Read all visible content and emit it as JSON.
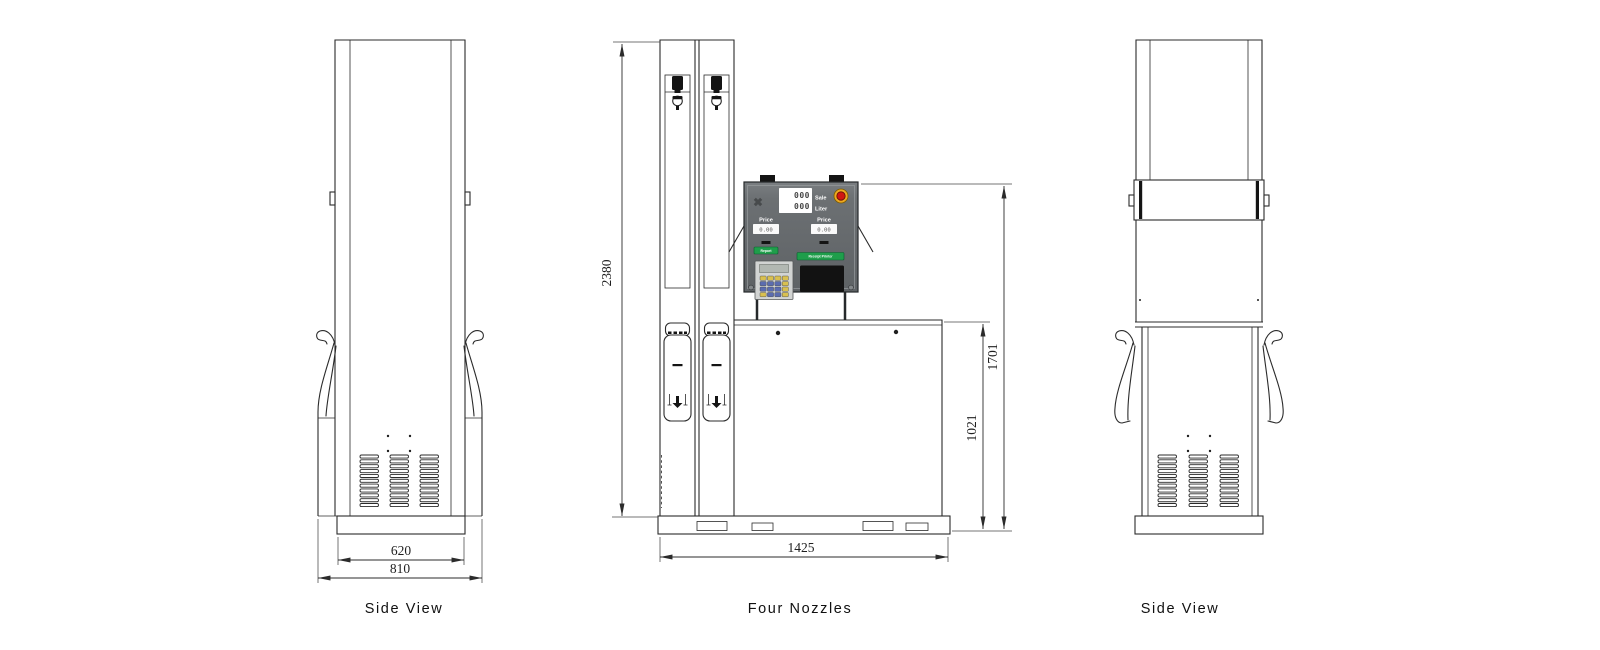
{
  "views": {
    "left": {
      "label": "Side View",
      "dim_top_width": "620",
      "dim_base_width": "810"
    },
    "front": {
      "label": "Four Nozzles",
      "dim_total_height": "2380",
      "dim_base_width": "1425",
      "dim_display_height": "1701",
      "dim_cabinet_height": "1021"
    },
    "right": {
      "label": "Side View"
    }
  },
  "panel": {
    "sale_label": "Sale",
    "liter_label": "Liter",
    "sale_value": "000",
    "liter_value": "000",
    "price_left_label": "Price",
    "price_right_label": "Price",
    "price_left_value": "0.00",
    "price_right_value": "0.00",
    "report_button_label": "Report",
    "receipt_button_label": "Receipt Printer"
  },
  "colors": {
    "line": "#2b2b2b",
    "panel_body": "#696d70",
    "button_green": "#1f9e4b",
    "estop_red": "#d01611",
    "estop_ring": "#eda81f",
    "keypad_blue": "#5b6cb0",
    "keypad_yellow": "#d9c050"
  }
}
